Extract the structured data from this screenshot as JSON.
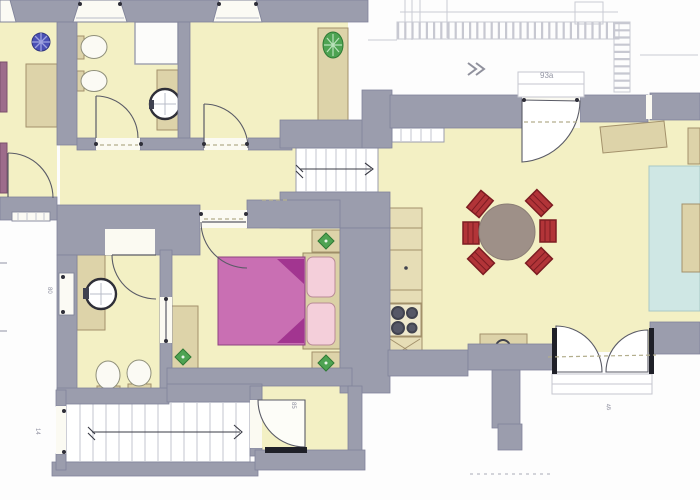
{
  "title": "apartment-floor-plan",
  "colors": {
    "paper": "#fdfdfd",
    "wall": "#9b9dad",
    "wallEdge": "#81849a",
    "room": "#f3f0c4",
    "white": "#fbfaf4",
    "furn": "#ddd3a9",
    "furnEdge": "#a3916b",
    "kitchen": "#e6ddb6",
    "bedPink": "#c96fb3",
    "bedDark": "#a23590",
    "pillow": "#f4cfda",
    "pillowEdge": "#b88a96",
    "chair": "#b23438",
    "chairEdge": "#7d1c22",
    "tableTop": "#9e9088",
    "rug": "#cfe7e4",
    "rugEdge": "#a8c9c6",
    "iconBlue": "#4a50b5",
    "iconGreen": "#4ea352",
    "duct": "#3f4150",
    "line": "#5a5b66",
    "stove": "#41434f",
    "sketch": "#b7b8c4",
    "textc": "#8f90a0",
    "jamb": "#2e2e38"
  },
  "annotations": {
    "sketch_label": "93a",
    "entrance_dim": "85",
    "terrace_dim": "46",
    "window_dim": "80",
    "stair_dim": "14"
  },
  "icons": {
    "fan": "fan-icon",
    "radiator_oval": "radiator-icon",
    "plant": "plant-icon"
  }
}
